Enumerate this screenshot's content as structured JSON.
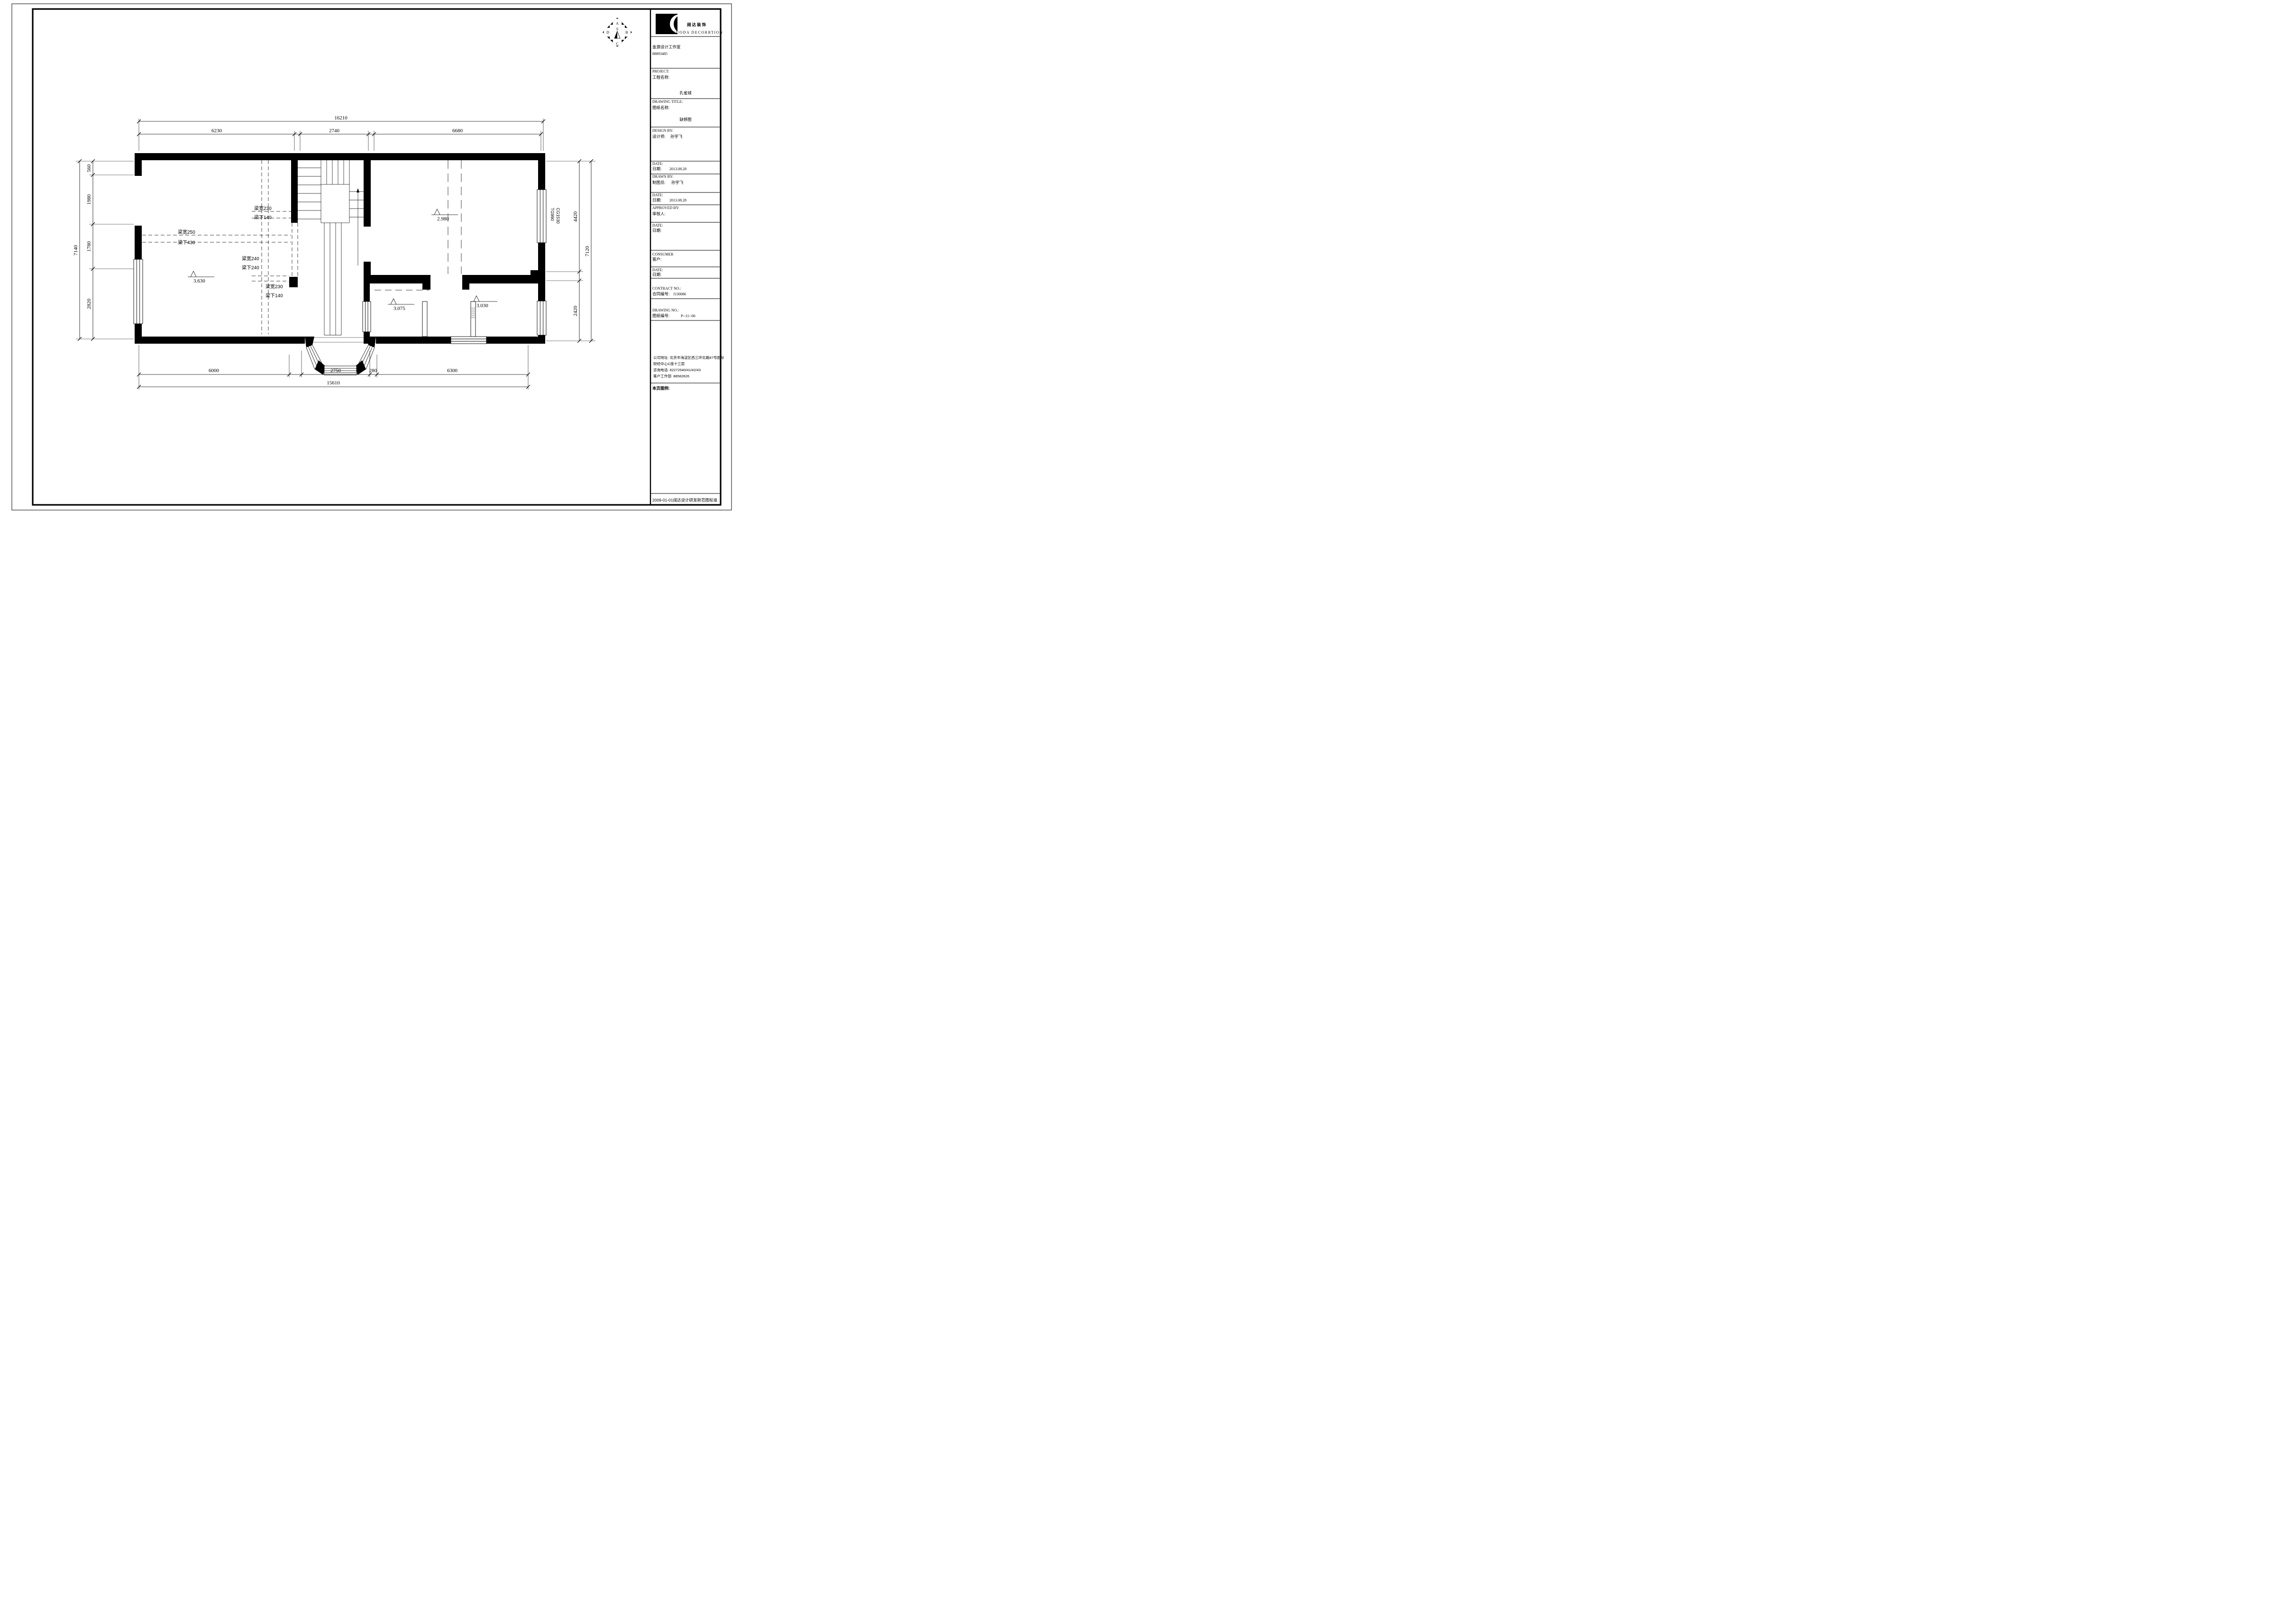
{
  "logo": {
    "company_cn": "阔达装饰",
    "company_en": "KUODA DECORRTION",
    "studio": "金源设计工作室",
    "studio_phone": "88893485"
  },
  "tb": {
    "project_en": "PROJECT:",
    "project_cn": "工程名称:",
    "project": "孔雀城",
    "title_en": "DRAWING TITLE:",
    "title_cn": "图纸名称:",
    "title": "缺憾图",
    "design_en": "DESIGN BY:",
    "design_cn": "设计师:",
    "designer": "孙宇飞",
    "date_en": "DATE:",
    "date_cn": "日期:",
    "date1": "2013.08.28",
    "drawn_en": "DRAWN BY:",
    "drawn_cn": "制图员:",
    "drafter": "孙宇飞",
    "date2": "2013.08.28",
    "approved_en": "APPROVED BY:",
    "approved_cn": "审核人:",
    "consumer_en": "CONSUMER",
    "consumer_cn": "客户:",
    "contract_en": "CONTRACT NO.:",
    "contract_cn": "合同编号:",
    "contract_no": "J130086",
    "dwgno_en": "DRAWING NO.:",
    "dwgno_cn": "图纸编号:",
    "dwgno": "P--11--06",
    "addr1": "公司地址: 北京市海淀区西三环北路87号国际",
    "addr2": "财经中心C座十三层",
    "addr3": "咨询电话: 82272540/41/42/43",
    "addr4": "客户工作部: 88582626",
    "legend": "本页图例:",
    "footer": "2009-01-01阔达设计研发新范图标准"
  },
  "north": {
    "a": "A",
    "b": "B",
    "c": "C",
    "d": "D",
    "s": "S"
  },
  "plan": {
    "dims_top": {
      "overall": "16210",
      "segs": [
        "6230",
        "2740",
        "6680"
      ]
    },
    "dims_bottom": {
      "overall": "15610",
      "segs": [
        "6000",
        "2750",
        "280",
        "6300"
      ]
    },
    "dims_left": {
      "overall": "7140",
      "segs": [
        "560",
        "1980",
        "1780",
        "2820"
      ]
    },
    "dims_right": {
      "overall": "7120",
      "segs": [
        "4420",
        "2420"
      ]
    },
    "beams": [
      {
        "w": "梁宽230",
        "u": "梁下140"
      },
      {
        "w": "梁宽250",
        "u": "梁下430"
      },
      {
        "w": "梁宽240",
        "u": "梁下240"
      },
      {
        "w": "梁宽230",
        "u": "梁下140"
      }
    ],
    "levels": [
      "3.630",
      "2.980",
      "3.075",
      "3.030"
    ],
    "tags": [
      "TG990",
      "CG1530"
    ]
  }
}
